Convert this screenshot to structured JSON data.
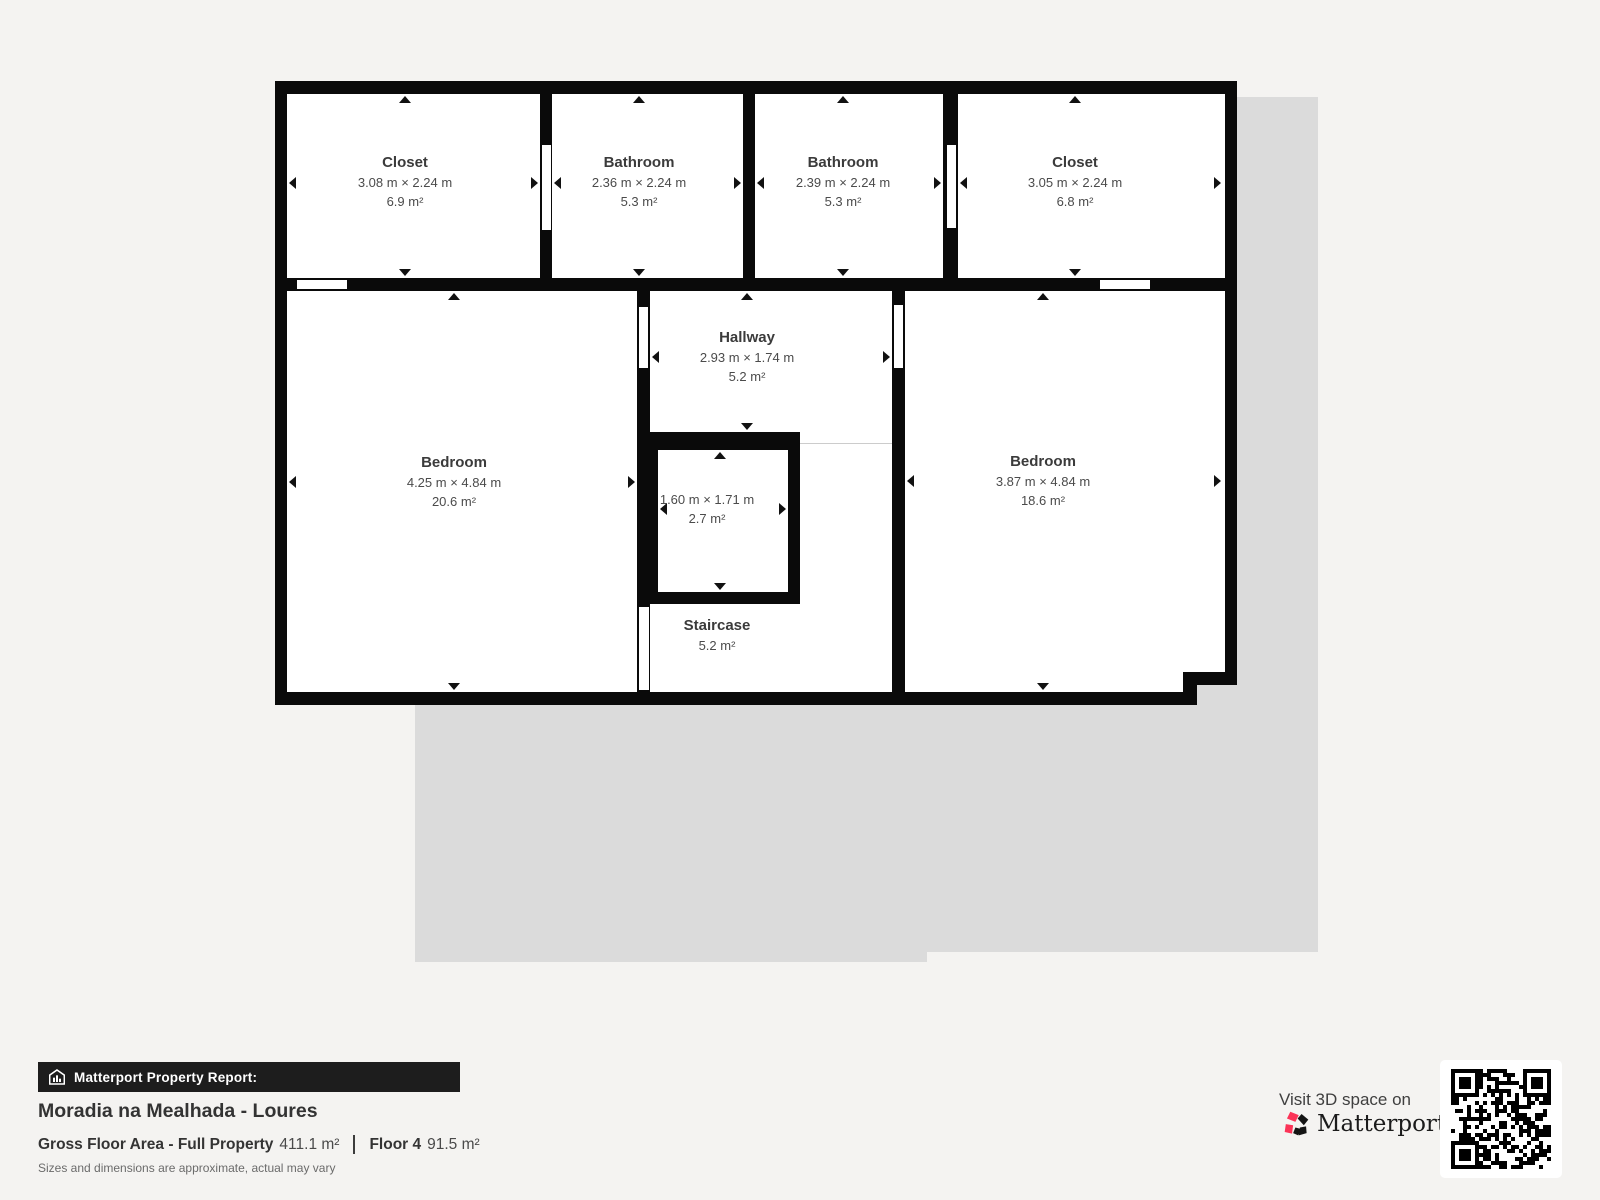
{
  "floorplan": {
    "rooms": [
      {
        "id": "closet-1",
        "name": "Closet",
        "dims": "3.08 m × 2.24 m",
        "area": "6.9 m²"
      },
      {
        "id": "bathroom-1",
        "name": "Bathroom",
        "dims": "2.36 m × 2.24 m",
        "area": "5.3 m²"
      },
      {
        "id": "bathroom-2",
        "name": "Bathroom",
        "dims": "2.39 m × 2.24 m",
        "area": "5.3 m²"
      },
      {
        "id": "closet-2",
        "name": "Closet",
        "dims": "3.05 m × 2.24 m",
        "area": "6.8 m²"
      },
      {
        "id": "bedroom-left",
        "name": "Bedroom",
        "dims": "4.25 m × 4.84 m",
        "area": "20.6 m²"
      },
      {
        "id": "hallway",
        "name": "Hallway",
        "dims": "2.93 m × 1.74 m",
        "area": "5.2 m²"
      },
      {
        "id": "small-room",
        "name": "",
        "dims": "1.60 m × 1.71 m",
        "area": "2.7 m²"
      },
      {
        "id": "staircase",
        "name": "Staircase",
        "dims": "",
        "area": "5.2 m²"
      },
      {
        "id": "bedroom-right",
        "name": "Bedroom",
        "dims": "3.87 m × 4.84 m",
        "area": "18.6 m²"
      }
    ]
  },
  "report": {
    "banner": "Matterport Property Report:",
    "property_title": "Moradia na Mealhada - Loures",
    "gross_label": "Gross Floor Area - Full Property",
    "gross_value": "411.1 m²",
    "floor_label": "Floor 4",
    "floor_value": "91.5 m²",
    "disclaimer": "Sizes and dimensions are approximate, actual may vary"
  },
  "cta": {
    "visit_text": "Visit 3D space on",
    "brand": "Matterport",
    "brand_mark": "ʼ"
  },
  "colors": {
    "background": "#f4f3f1",
    "other_floor_silhouette": "#dbdbdb",
    "wall": "#0a0a0a",
    "room_fill": "#ffffff",
    "banner_bg": "#1d1d1d",
    "brand_pink": "#fb3357"
  }
}
